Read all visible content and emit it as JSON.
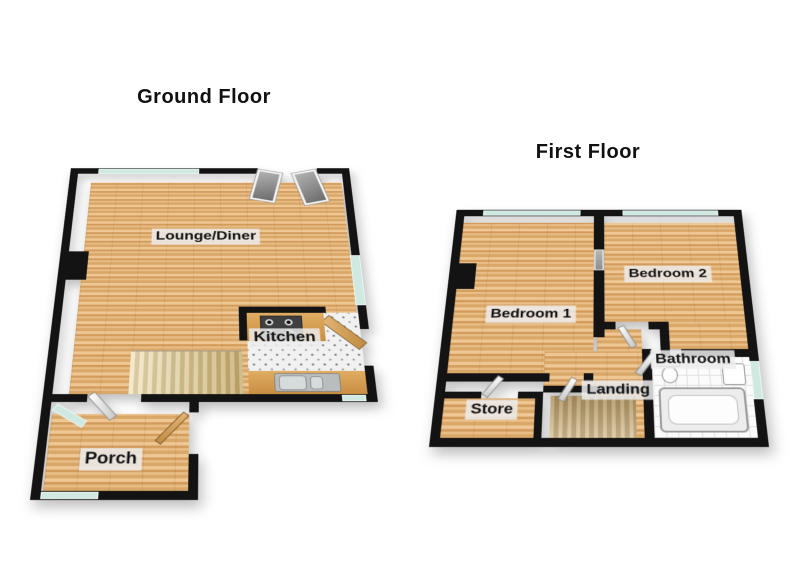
{
  "page": {
    "background": "#ffffff"
  },
  "colors": {
    "wall": "#131313",
    "wood_floor": "#dcab6e",
    "kitchen_tile": "#f1f1f1",
    "bathroom_tile": "#fbfbfb",
    "window_glass": "#cfe9e2",
    "stairs": "#d9c492",
    "label_background": "#ececec",
    "text": "#111111"
  },
  "floors": {
    "ground": {
      "title": "Ground Floor",
      "rooms": {
        "lounge": {
          "label": "Lounge/Diner"
        },
        "kitchen": {
          "label": "Kitchen"
        },
        "porch": {
          "label": "Porch"
        }
      }
    },
    "first": {
      "title": "First Floor",
      "rooms": {
        "bedroom1": {
          "label": "Bedroom 1"
        },
        "bedroom2": {
          "label": "Bedroom 2"
        },
        "bathroom": {
          "label": "Bathroom"
        },
        "landing": {
          "label": "Landing"
        },
        "store": {
          "label": "Store"
        }
      }
    }
  }
}
